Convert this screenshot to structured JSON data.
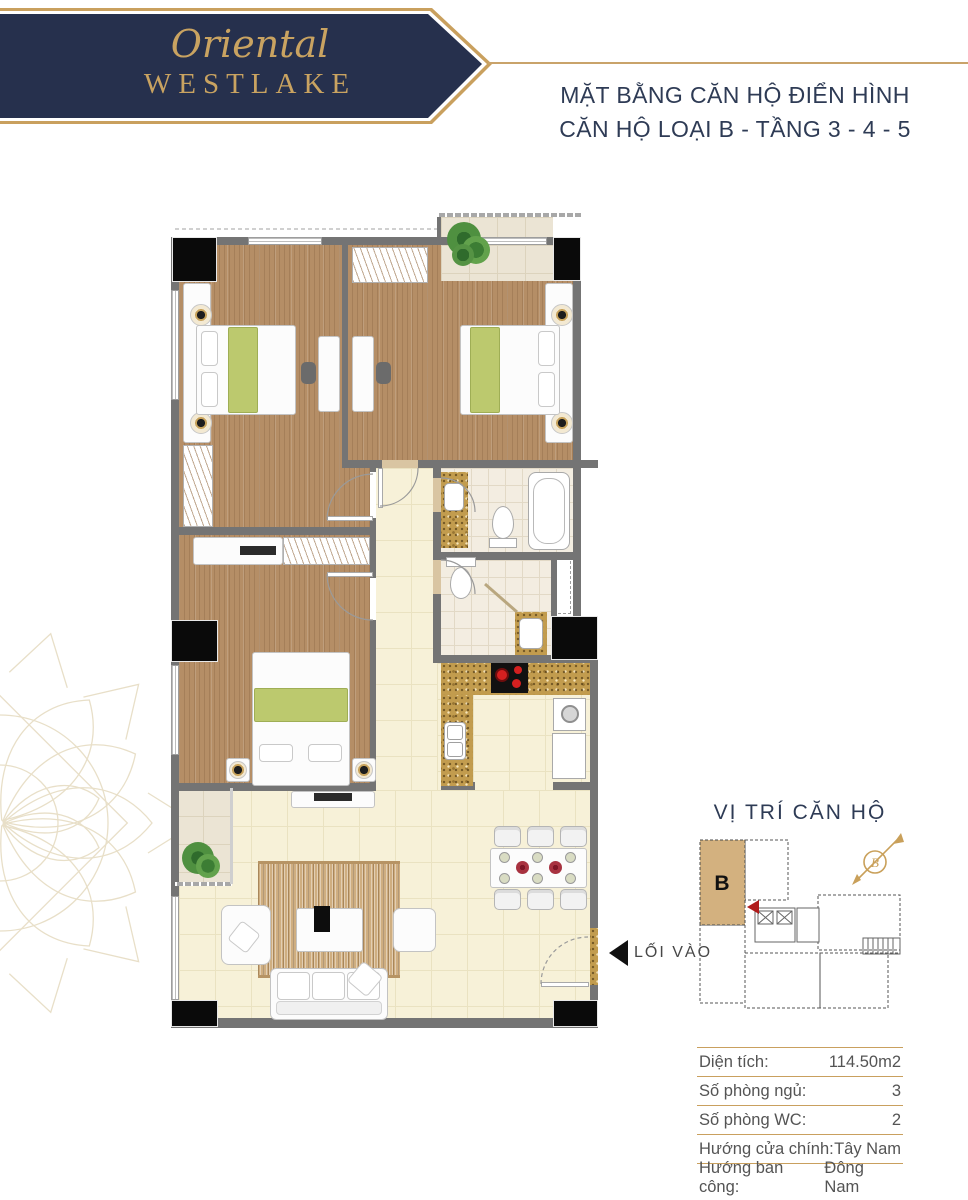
{
  "brand": {
    "script": "Oriental",
    "name": "WESTLAKE"
  },
  "header": {
    "title_line1": "MẶT BẰNG CĂN HỘ ĐIỂN HÌNH",
    "title_line2": "CĂN HỘ LOẠI B - TẦNG 3 - 4 - 5"
  },
  "plan": {
    "entrance_label": "LỐI VÀO"
  },
  "location": {
    "title": "VỊ TRÍ CĂN HỘ",
    "unit_label": "B",
    "compass_letter": "B"
  },
  "info": {
    "rows": [
      {
        "label": "Diện tích:",
        "value": "114.50m2"
      },
      {
        "label": "Số phòng ngủ:",
        "value": "3"
      },
      {
        "label": "Số phòng WC:",
        "value": "2"
      },
      {
        "label": "Hướng cửa chính:",
        "value": "Tây Nam"
      },
      {
        "label": "Hướng ban công:",
        "value": "Đông Nam"
      }
    ]
  },
  "colors": {
    "navy": "#26304d",
    "gold": "#c9a05e",
    "wood": "#b58e66",
    "cream_tile": "#f7f1d8",
    "unit_highlight": "#d3b17f",
    "marker_red": "#b01c1c"
  }
}
